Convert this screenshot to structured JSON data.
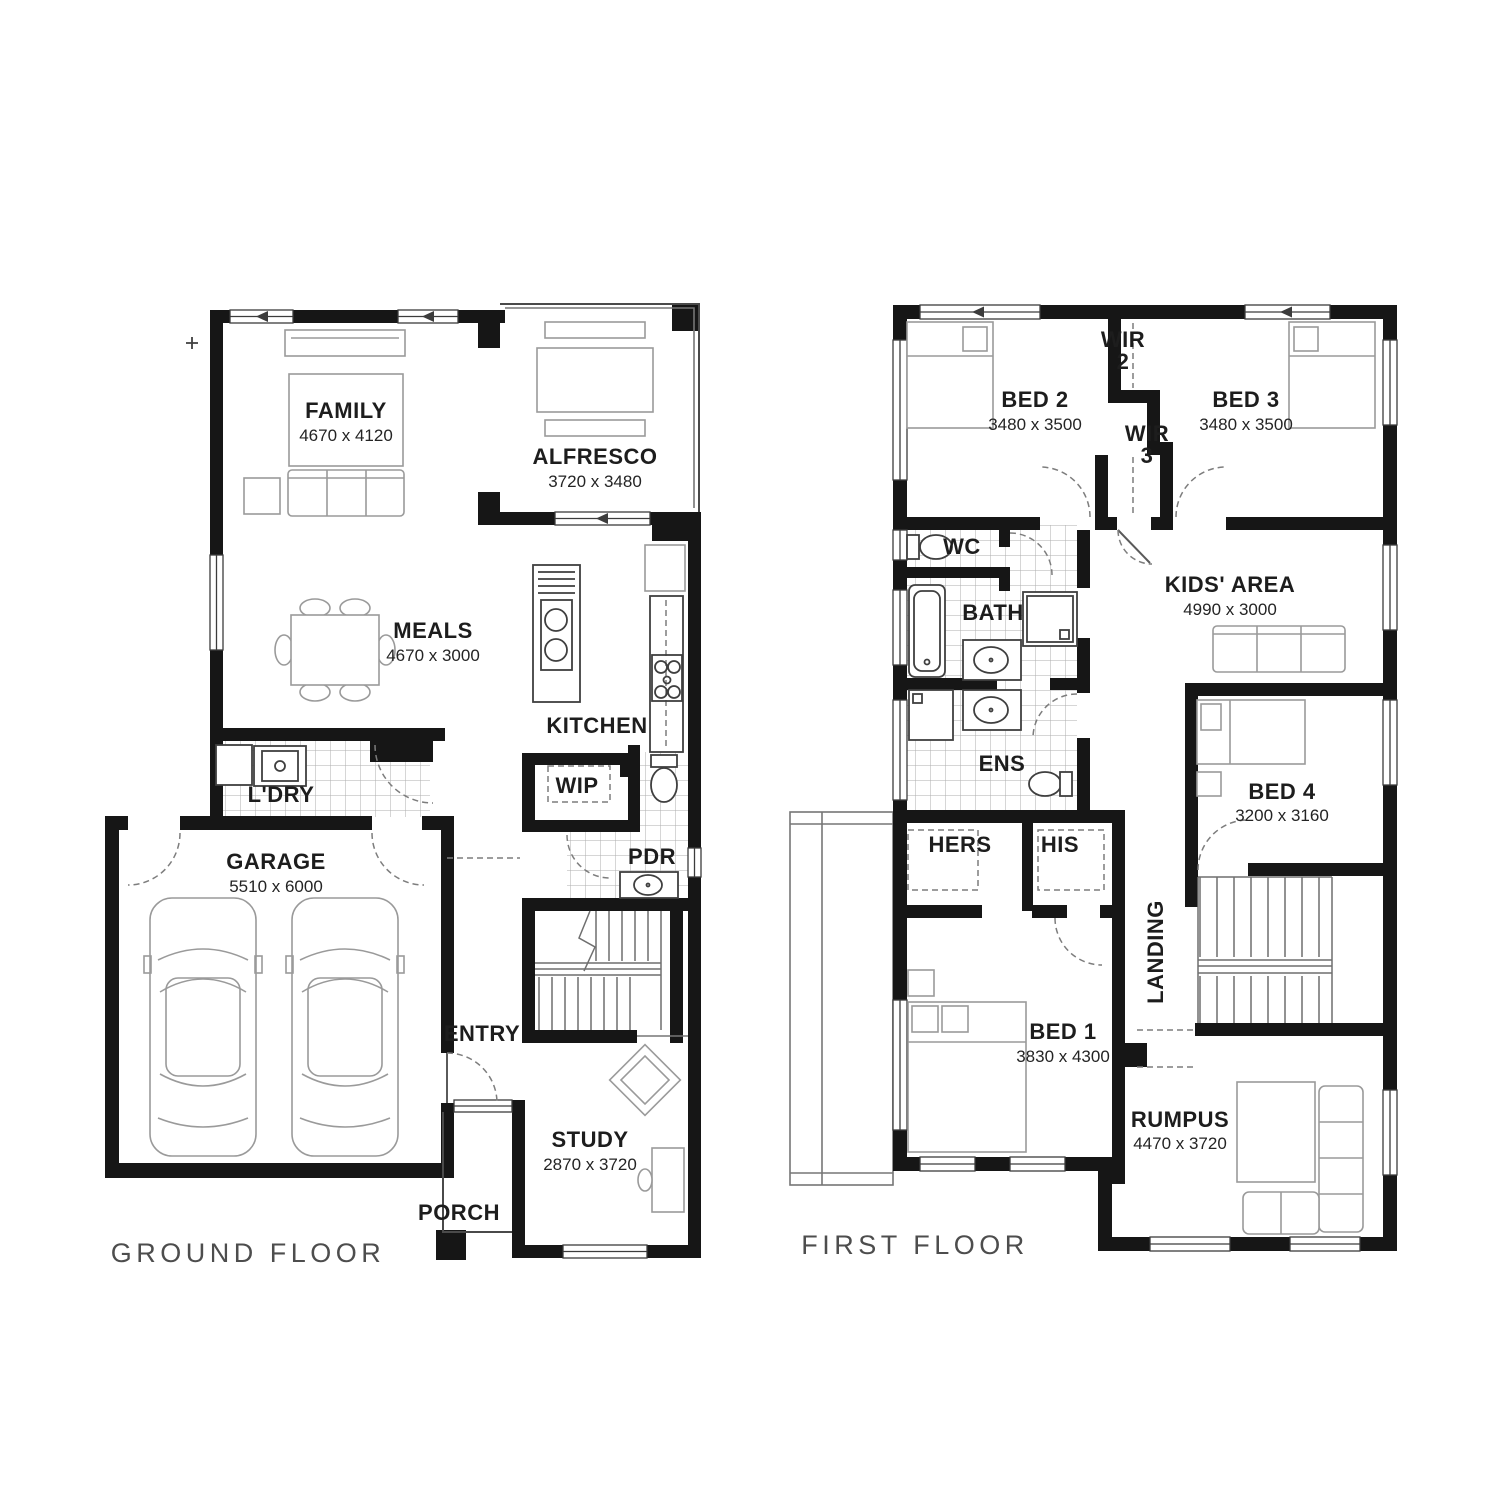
{
  "palette": {
    "wall": "#161616",
    "furniture_line": "#9a9a9a",
    "fixture_line": "#3f3f3f",
    "tile_line": "#d4d4d4",
    "door_arc": "#7d7d7d",
    "caption": "#4d4d4d",
    "background": "#ffffff"
  },
  "g": {
    "caption": "GROUND FLOOR",
    "family": {
      "name": "FAMILY",
      "dims": "4670 x 4120"
    },
    "alfresco": {
      "name": "ALFRESCO",
      "dims": "3720 x 3480"
    },
    "meals": {
      "name": "MEALS",
      "dims": "4670 x 3000"
    },
    "kitchen": {
      "name": "KITCHEN"
    },
    "ldry": {
      "name": "L'DRY"
    },
    "wip": {
      "name": "WIP"
    },
    "pdr": {
      "name": "PDR"
    },
    "garage": {
      "name": "GARAGE",
      "dims": "5510 x 6000"
    },
    "entry": {
      "name": "ENTRY"
    },
    "study": {
      "name": "STUDY",
      "dims": "2870 x 3720"
    },
    "porch": {
      "name": "PORCH"
    }
  },
  "f": {
    "caption": "FIRST FLOOR",
    "bed2": {
      "name": "BED 2",
      "dims": "3480 x 3500"
    },
    "wir2": {
      "name": "WIR",
      "num": "2"
    },
    "bed3": {
      "name": "BED 3",
      "dims": "3480 x 3500"
    },
    "wir3": {
      "name": "WIR",
      "num": "3"
    },
    "wc": {
      "name": "WC"
    },
    "bath": {
      "name": "BATH"
    },
    "kids": {
      "name": "KIDS' AREA",
      "dims": "4990 x 3000"
    },
    "ens": {
      "name": "ENS"
    },
    "bed4": {
      "name": "BED 4",
      "dims": "3200 x 3160"
    },
    "hers": {
      "name": "HERS"
    },
    "his": {
      "name": "HIS"
    },
    "landing": {
      "name": "LANDING"
    },
    "bed1": {
      "name": "BED 1",
      "dims": "3830 x 4300"
    },
    "rumpus": {
      "name": "RUMPUS",
      "dims": "4470 x 3720"
    }
  }
}
